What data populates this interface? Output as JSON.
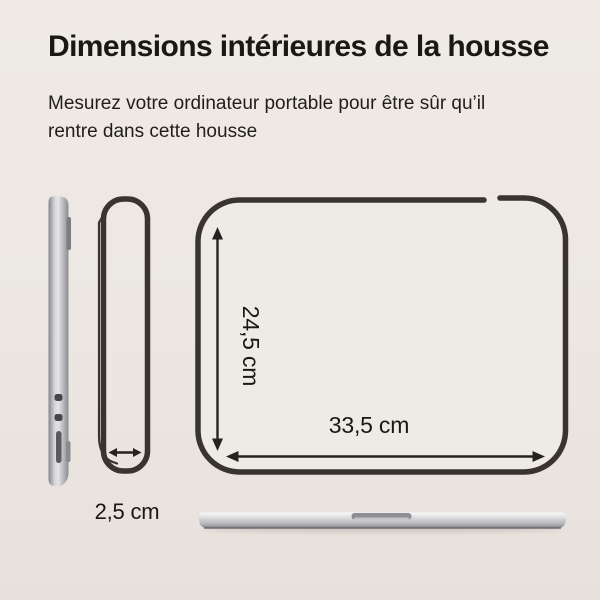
{
  "header": {
    "title": "Dimensions intérieures de la housse",
    "subtitle_line1": "Mesurez votre ordinateur portable pour être sûr qu’il",
    "subtitle_line2": "rentre dans cette housse"
  },
  "diagram": {
    "height_label": "24,5 cm",
    "width_label": "33,5 cm",
    "depth_label": "2,5 cm",
    "icons": {
      "height_arrow": "double-headed-vertical-arrow",
      "width_arrow": "double-headed-horizontal-arrow",
      "depth_arrow": "double-headed-horizontal-arrow"
    }
  },
  "colors": {
    "background": "#ece7e2",
    "outline": "#3a3430",
    "arrow": "#262220",
    "text": "#1b1713",
    "laptop-silver": "#c6c6ca"
  }
}
